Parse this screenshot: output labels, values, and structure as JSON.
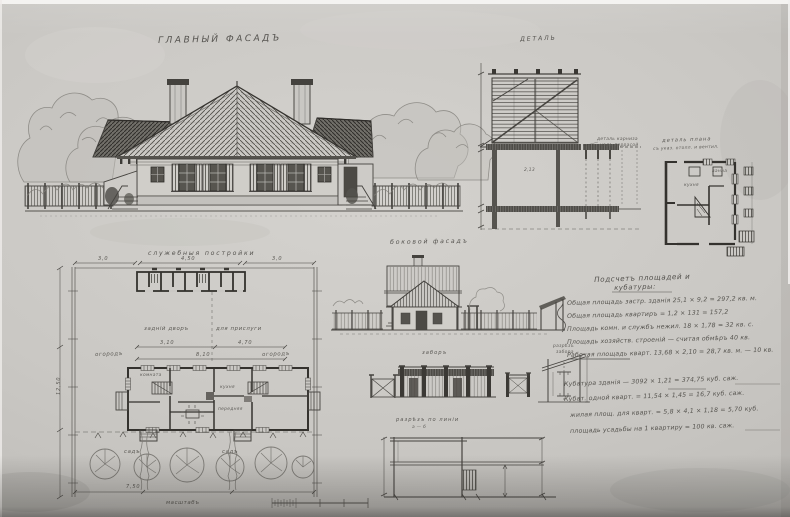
{
  "titles": {
    "main_facade": "ГЛАВНЫЙ  ФАСАДЪ",
    "detail": "ДЕТАЛЬ",
    "service_buildings": "служебныя постройки",
    "side_facade": "боковой фасадъ",
    "fence": "заборъ",
    "plan_detail_1": "деталь плана",
    "plan_detail_2": "съ указ. отопл. и вентил.",
    "lean_to_1": "разрѣзъ",
    "lean_to_2": "забора",
    "bottom_section_1": "разрѣзъ по линіи",
    "bottom_section_2": "а — б",
    "cornice_note_1": "деталь карниза",
    "cornice_note_2": "надъ террасой",
    "scale_caption": "масштабъ"
  },
  "plan": {
    "yard_left": "задній дворъ",
    "yard_right": "для прислуги",
    "garden_left": "садъ",
    "garden_right": "садъ",
    "field_left": "огородъ",
    "field_right": "огородъ",
    "room_kitchen": "кухня",
    "room_hall": "передняя",
    "room_living": "комната",
    "dims": {
      "top_left": "3,0",
      "top_mid": "4,50",
      "top_right": "3,0",
      "mid_left": "3,10",
      "mid_right": "4,70",
      "mid_total": "8,10",
      "left_vert": "12,50",
      "bottom": "7,50"
    }
  },
  "plan_detail": {
    "room_1": "кухня",
    "room_2": "ванна"
  },
  "section": {
    "room_dim": "2,13"
  },
  "notes": {
    "heading_1": "Подсчетъ площадей и",
    "heading_2": "кубатуры:",
    "lines": [
      "Общая площадь застр. зданія 25,1 × 9,2 = 297,2 кв. м.",
      "Общая площадь квартиръ = 1,2 × 131 = 157,2",
      "Площадь комн. и службъ нежил. 18 × 1,78 = 32 кв. с.",
      "Площадь хозяйств. строеній — считая обмѣръ 40 кв.",
      "Рабочая площадь кварт. 13,68 × 2,10 = 28,7 кв. м. — 10 кв."
    ],
    "lines2": [
      "Кубатура зданія — 3092 × 1,21 = 374,75 куб. саж.",
      "Кубат. одной кварт. = 11,54 × 1,45 = 16,7 куб. саж.",
      "жилая площ. для кварт. = 5,8 × 4,1 × 1,18 = 5,70 куб.",
      "площадь усадьбы на 1 квартиру = 100 кв. саж."
    ]
  }
}
